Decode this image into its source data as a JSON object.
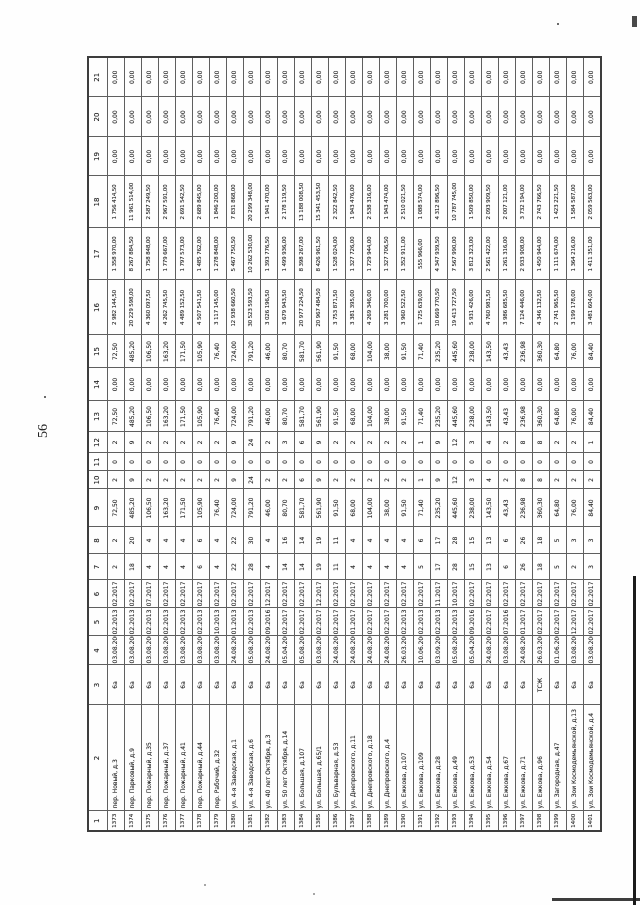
{
  "page": {
    "number": "56"
  },
  "table": {
    "description": "Scanned table rotated 90 degrees on page; housing program listing",
    "column_headers": [
      "1",
      "2",
      "3",
      "4",
      "5",
      "6",
      "7",
      "8",
      "9",
      "10",
      "11",
      "12",
      "13",
      "14",
      "15",
      "16",
      "17",
      "18",
      "19",
      "20",
      "21"
    ],
    "rows": [
      [
        "1373",
        "пер. Новый, д.3",
        "6а",
        "03.08.2005",
        "02.2013",
        "02.2017",
        "2",
        "2",
        "72,50",
        "2",
        "0",
        "2",
        "72,50",
        "0,00",
        "72,50",
        "2 982 144,50",
        "1 358 970,00",
        "1 756 414,50",
        "0,00",
        "0,00",
        "0,00"
      ],
      [
        "1374",
        "пер. Парковый, д.9",
        "6а",
        "03.08.2005",
        "02.2013",
        "02.2017",
        "18",
        "20",
        "485,20",
        "9",
        "0",
        "9",
        "485,20",
        "0,00",
        "485,20",
        "20 229 598,00",
        "8 267 884,50",
        "11 961 514,00",
        "0,00",
        "0,00",
        "0,00"
      ],
      [
        "1375",
        "пер. Пожарный, д.35",
        "6а",
        "03.08.2005",
        "02.2013",
        "07.2017",
        "4",
        "4",
        "106,50",
        "2",
        "0",
        "2",
        "106,50",
        "0,00",
        "106,50",
        "4 360 097,50",
        "1 758 848,00",
        "2 587 249,50",
        "0,00",
        "0,00",
        "0,00"
      ],
      [
        "1376",
        "пер. Пожарный, д.37",
        "6а",
        "03.08.2005",
        "02.2013",
        "02.2017",
        "4",
        "4",
        "163,20",
        "2",
        "0",
        "2",
        "163,20",
        "0,00",
        "163,20",
        "4 262 745,50",
        "1 779 667,00",
        "2 967 591,00",
        "0,00",
        "0,00",
        "0,00"
      ],
      [
        "1377",
        "пер. Пожарный, д.41",
        "6а",
        "03.08.2005",
        "02.2013",
        "02.2017",
        "4",
        "4",
        "171,50",
        "2",
        "0",
        "2",
        "171,50",
        "0,00",
        "171,50",
        "4 489 152,50",
        "1 797 573,00",
        "2 691 542,50",
        "0,00",
        "0,00",
        "0,00"
      ],
      [
        "1378",
        "пер. Пожарный, д.44",
        "6а",
        "03.08.2005",
        "02.2013",
        "02.2017",
        "6",
        "6",
        "105,90",
        "2",
        "0",
        "2",
        "105,90",
        "0,00",
        "105,90",
        "4 507 541,50",
        "1 485 762,00",
        "2 689 845,00",
        "0,00",
        "0,00",
        "0,00"
      ],
      [
        "1379",
        "пер. Рабочий, д.32",
        "6а",
        "03.08.2005",
        "10.2013",
        "02.2017",
        "4",
        "4",
        "76,40",
        "2",
        "0",
        "2",
        "76,40",
        "0,00",
        "76,40",
        "3 117 145,00",
        "1 278 848,00",
        "1 846 200,00",
        "0,00",
        "0,00",
        "0,00"
      ],
      [
        "1380",
        "ул. 4-я Заводская, д.1",
        "6а",
        "24.08.2005",
        "01.2013",
        "02.2017",
        "22",
        "22",
        "724,00",
        "9",
        "0",
        "9",
        "724,00",
        "0,00",
        "724,00",
        "12 938 660,50",
        "5 467 750,50",
        "7 831 868,00",
        "0,00",
        "0,00",
        "0,00"
      ],
      [
        "1381",
        "ул. 4-я Заводская, д.6",
        "6а",
        "05.08.2005",
        "02.2013",
        "02.2017",
        "28",
        "30",
        "791,20",
        "24",
        "0",
        "24",
        "791,20",
        "0,00",
        "791,20",
        "30 523 593,50",
        "10 262 530,00",
        "20 299 348,00",
        "0,00",
        "0,00",
        "0,00"
      ],
      [
        "1382",
        "ул. 40 лет Октября, д.3",
        "6а",
        "24.08.2005",
        "09.2016",
        "12.2017",
        "4",
        "4",
        "46,00",
        "2",
        "0",
        "2",
        "46,00",
        "0,00",
        "46,00",
        "3 026 196,50",
        "1 393 776,50",
        "1 941 470,00",
        "0,00",
        "0,00",
        "0,00"
      ],
      [
        "1383",
        "ул. 50 лет Октября, д.14",
        "6а",
        "05.04.2005",
        "02.2017",
        "02.2017",
        "14",
        "16",
        "80,70",
        "2",
        "0",
        "3",
        "80,70",
        "0,00",
        "80,70",
        "3 679 943,50",
        "1 499 936,00",
        "2 178 119,50",
        "0,00",
        "0,00",
        "0,00"
      ],
      [
        "1384",
        "ул. Большая, д.107",
        "6а",
        "05.08.2005",
        "02.2017",
        "02.2017",
        "14",
        "14",
        "581,70",
        "6",
        "0",
        "6",
        "581,70",
        "0,00",
        "581,70",
        "20 977 224,50",
        "8 398 267,00",
        "13 188 008,50",
        "0,00",
        "0,00",
        "0,00"
      ],
      [
        "1385",
        "ул. Большая, д.65/1",
        "6а",
        "03.08.2005",
        "02.2017",
        "12.2017",
        "19",
        "19",
        "561,90",
        "9",
        "0",
        "9",
        "561,90",
        "0,00",
        "561,90",
        "20 967 484,50",
        "8 426 961,50",
        "15 341 453,50",
        "0,00",
        "0,00",
        "0,00"
      ],
      [
        "1386",
        "ул. Бульварная, д.53",
        "6а",
        "24.08.2005",
        "02.2017",
        "02.2017",
        "11",
        "11",
        "91,50",
        "2",
        "0",
        "2",
        "91,50",
        "0,00",
        "91,50",
        "3 753 871,50",
        "1 528 024,00",
        "2 322 842,50",
        "0,00",
        "0,00",
        "0,00"
      ],
      [
        "1387",
        "ул. Днепровского, д.11",
        "6а",
        "24.08.2005",
        "01.2017",
        "02.2017",
        "4",
        "4",
        "68,00",
        "2",
        "0",
        "2",
        "68,00",
        "0,00",
        "68,00",
        "3 381 395,00",
        "1 327 726,00",
        "1 943 476,00",
        "0,00",
        "0,00",
        "0,00"
      ],
      [
        "1388",
        "ул. Днепровского, д.18",
        "6а",
        "24.08.2005",
        "02.2017",
        "02.2017",
        "4",
        "4",
        "104,00",
        "2",
        "0",
        "2",
        "104,00",
        "0,00",
        "104,00",
        "4 269 346,00",
        "1 729 944,00",
        "2 538 316,00",
        "0,00",
        "0,00",
        "0,00"
      ],
      [
        "1389",
        "ул. Днепровского, д.4",
        "6а",
        "24.08.2005",
        "02.2017",
        "02.2017",
        "4",
        "4",
        "38,00",
        "2",
        "0",
        "2",
        "38,00",
        "0,00",
        "38,00",
        "3 281 700,00",
        "1 327 706,50",
        "1 943 474,00",
        "0,00",
        "0,00",
        "0,00"
      ],
      [
        "1390",
        "ул. Ежкова, д.107",
        "6а",
        "26.03.2005",
        "02.2013",
        "02.2017",
        "4",
        "4",
        "91,50",
        "2",
        "0",
        "2",
        "91,50",
        "0,00",
        "91,50",
        "3 960 522,50",
        "1 352 911,00",
        "2 510 021,50",
        "0,00",
        "0,00",
        "0,00"
      ],
      [
        "1391",
        "ул. Ежкова, д.109",
        "6а",
        "10.06.2005",
        "02.2013",
        "02.2017",
        "5",
        "6",
        "71,40",
        "1",
        "0",
        "1",
        "71,40",
        "0,00",
        "71,40",
        "1 725 639,00",
        "555 966,00",
        "1 088 574,00",
        "0,00",
        "0,00",
        "0,00"
      ],
      [
        "1392",
        "ул. Ежкова, д.28",
        "6а",
        "03.09.2005",
        "02.2013",
        "11.2017",
        "17",
        "17",
        "235,20",
        "9",
        "0",
        "9",
        "235,20",
        "0,00",
        "235,20",
        "10 669 770,50",
        "4 347 939,50",
        "4 312 896,50",
        "0,00",
        "0,00",
        "0,00"
      ],
      [
        "1393",
        "ул. Ежкова, д.49",
        "6а",
        "05.08.2005",
        "02.2013",
        "10.2017",
        "28",
        "28",
        "445,60",
        "12",
        "0",
        "12",
        "445,60",
        "0,00",
        "445,60",
        "19 413 727,50",
        "7 567 990,00",
        "10 787 745,00",
        "0,00",
        "0,00",
        "0,00"
      ],
      [
        "1394",
        "ул. Ежкова, д.53",
        "6а",
        "05.04.2005",
        "09.2016",
        "02.2017",
        "15",
        "15",
        "238,00",
        "3",
        "0",
        "3",
        "238,00",
        "0,00",
        "238,00",
        "5 931 426,00",
        "3 812 323,00",
        "1 509 850,00",
        "0,00",
        "0,00",
        "0,00"
      ],
      [
        "1395",
        "ул. Ежкова, д.54",
        "6а",
        "24.08.2005",
        "02.2017",
        "02.2017",
        "13",
        "13",
        "143,50",
        "4",
        "0",
        "4",
        "143,50",
        "0,00",
        "143,50",
        "4 760 981,50",
        "2 561 422,00",
        "2 093 909,50",
        "0,00",
        "0,00",
        "0,00"
      ],
      [
        "1396",
        "ул. Ежкова, д.67",
        "6а",
        "03.08.2005",
        "07.2016",
        "02.2017",
        "6",
        "6",
        "43,43",
        "2",
        "0",
        "2",
        "43,43",
        "0,00",
        "43,43",
        "3 986 685,50",
        "1 261 316,00",
        "2 007 121,00",
        "0,00",
        "0,00",
        "0,00"
      ],
      [
        "1397",
        "ул. Ежкова, д.71",
        "6а",
        "24.08.2005",
        "01.2017",
        "02.2017",
        "26",
        "26",
        "236,98",
        "8",
        "0",
        "8",
        "236,98",
        "0,00",
        "236,98",
        "7 124 446,00",
        "2 933 908,00",
        "3 732 194,00",
        "0,00",
        "0,00",
        "0,00"
      ],
      [
        "1398",
        "ул. Ежкова, д.96",
        "ТСЖ",
        "26.03.2005",
        "02.2017",
        "02.2017",
        "18",
        "18",
        "360,30",
        "8",
        "0",
        "8",
        "360,30",
        "0,00",
        "360,30",
        "4 346 132,50",
        "1 450 944,00",
        "2 743 766,50",
        "0,00",
        "0,00",
        "0,00"
      ],
      [
        "1399",
        "ул. Загородная, д.47",
        "6а",
        "01.06.2005",
        "02.2017",
        "02.2017",
        "5",
        "5",
        "64,80",
        "2",
        "0",
        "2",
        "64,80",
        "0,00",
        "64,80",
        "2 741 965,50",
        "1 111 674,00",
        "1 423 221,50",
        "0,00",
        "0,00",
        "0,00"
      ],
      [
        "1400",
        "ул. Зои Космодемьянской, д.13",
        "6а",
        "03.08.2004",
        "12.2017",
        "02.2017",
        "2",
        "3",
        "76,00",
        "2",
        "0",
        "2",
        "76,00",
        "0,00",
        "76,00",
        "3 199 178,00",
        "1 364 216,00",
        "1 584 587,00",
        "0,00",
        "0,00",
        "0,00"
      ],
      [
        "1401",
        "ул. Зои Космодемьянской, д.4",
        "6а",
        "03.08.2005",
        "02.2017",
        "02.2017",
        "3",
        "3",
        "84,40",
        "2",
        "0",
        "1",
        "84,40",
        "0,00",
        "84,40",
        "3 481 604,00",
        "1 411 351,00",
        "2 059 563,00",
        "0,00",
        "0,00",
        "0,00"
      ]
    ]
  }
}
